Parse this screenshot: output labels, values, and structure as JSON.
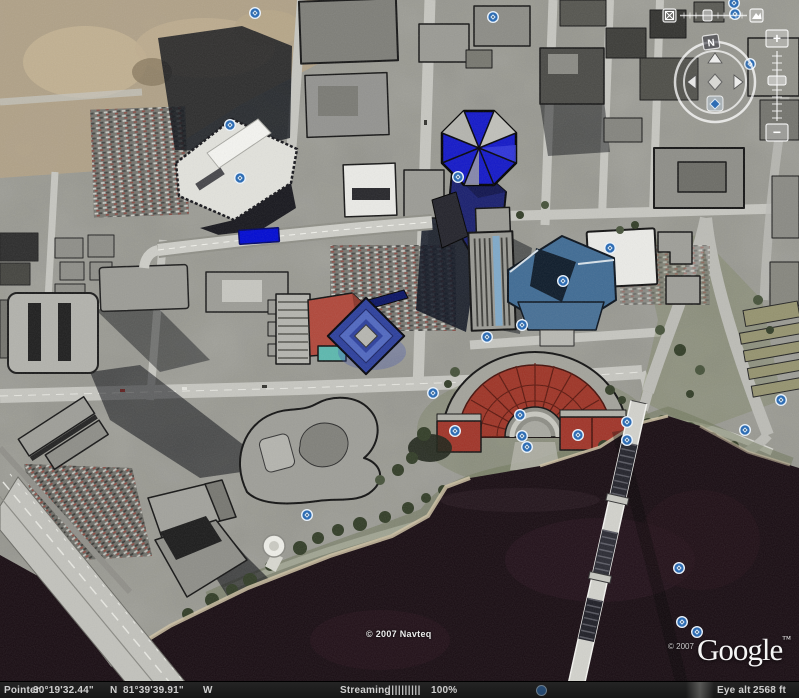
{
  "map": {
    "attribution_navteq": "© 2007 Navteq",
    "attribution_copyright": "© 2007",
    "logo_text": "Google",
    "logo_tm": "™",
    "colors": {
      "placemark_blue": "#2e6db4",
      "building_blue": "#1318c8",
      "building_red": "#9e3426",
      "building_red_light": "#b0473a",
      "roof_slate": "#3f6b94",
      "highlight_blue": "#000ad2",
      "water": "#180c12"
    },
    "icons": {
      "placemark": "blue-circle-diamond",
      "tilt_flat_button": "boxed-x",
      "tilt_full_button": "mountain",
      "compass": "ring-with-arrows"
    },
    "placemarks": [
      {
        "x": 255,
        "y": 13
      },
      {
        "x": 493,
        "y": 17
      },
      {
        "x": 230,
        "y": 125
      },
      {
        "x": 240,
        "y": 178
      },
      {
        "x": 458,
        "y": 177
      },
      {
        "x": 610,
        "y": 248
      },
      {
        "x": 563,
        "y": 281
      },
      {
        "x": 522,
        "y": 325
      },
      {
        "x": 487,
        "y": 337
      },
      {
        "x": 307,
        "y": 515
      },
      {
        "x": 433,
        "y": 393
      },
      {
        "x": 455,
        "y": 431
      },
      {
        "x": 520,
        "y": 415
      },
      {
        "x": 522,
        "y": 436
      },
      {
        "x": 527,
        "y": 447
      },
      {
        "x": 578,
        "y": 435
      },
      {
        "x": 627,
        "y": 422
      },
      {
        "x": 627,
        "y": 440
      },
      {
        "x": 745,
        "y": 430
      },
      {
        "x": 679,
        "y": 568
      },
      {
        "x": 682,
        "y": 622
      },
      {
        "x": 697,
        "y": 632
      },
      {
        "x": 781,
        "y": 400
      },
      {
        "x": 734,
        "y": 3
      },
      {
        "x": 735,
        "y": 14
      },
      {
        "x": 750,
        "y": 64
      }
    ]
  },
  "navigation": {
    "north_label": "N",
    "zoom_in_label": "+",
    "zoom_out_label": "−"
  },
  "status_bar": {
    "pointer_label": "Pointer",
    "latitude": "30°19'32.44\"",
    "lat_hemisphere": "N",
    "longitude": "81°39'39.91\"",
    "lon_hemisphere": "W",
    "streaming_label": "Streaming",
    "streaming_bars": "||||||||||",
    "streaming_percent": "100%",
    "eye_alt_label": "Eye alt",
    "eye_alt_value": "2568 ft"
  }
}
